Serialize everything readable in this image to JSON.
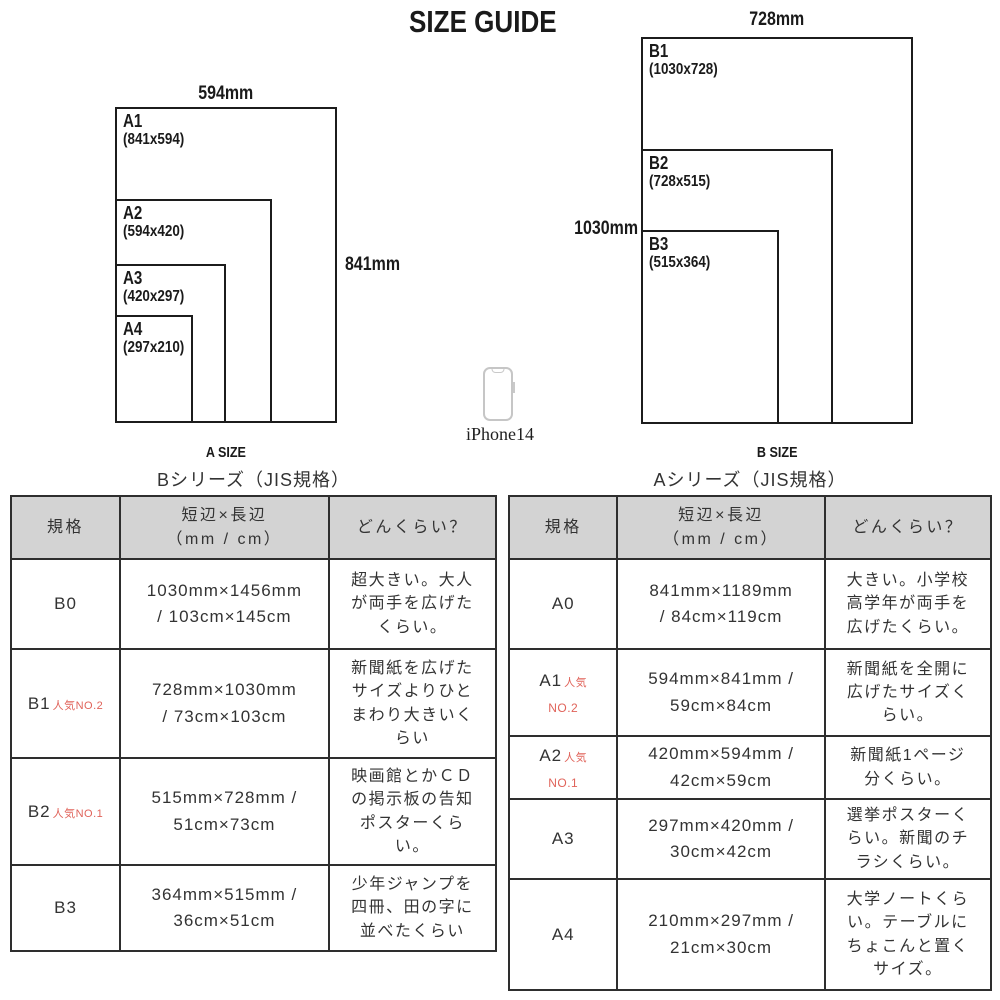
{
  "page_title": "SIZE GUIDE",
  "colors": {
    "accent_red": "#e0635a",
    "header_bg": "#d3d3d3",
    "border": "#2e2e2e"
  },
  "phone": {
    "label": "iPhone14"
  },
  "diagram_a": {
    "caption": "A SIZE",
    "top_dim": "594mm",
    "side_dim": "841mm",
    "sizes": [
      {
        "name": "A1",
        "dims": "(841x594)"
      },
      {
        "name": "A2",
        "dims": "(594x420)"
      },
      {
        "name": "A3",
        "dims": "(420x297)"
      },
      {
        "name": "A4",
        "dims": "(297x210)"
      }
    ]
  },
  "diagram_b": {
    "caption": "B SIZE",
    "top_dim": "728mm",
    "side_dim": "1030mm",
    "sizes": [
      {
        "name": "B1",
        "dims": "(1030x728)"
      },
      {
        "name": "B2",
        "dims": "(728x515)"
      },
      {
        "name": "B3",
        "dims": "(515x364)"
      }
    ]
  },
  "tables": [
    {
      "title": "Bシリーズ（JIS規格）",
      "headers": [
        "規格",
        "短辺×長辺\n（mm / cm）",
        "どんくらい？"
      ],
      "rows": [
        {
          "size": "B0",
          "tag": "",
          "tag_line2": "",
          "dims": "1030mm×1456mm\n/ 103cm×145cm",
          "desc": "超大きい。大人\nが両手を広げた\nくらい。"
        },
        {
          "size": "B1",
          "tag": "人気NO.2",
          "tag_line2": "",
          "dims": "728mm×1030mm\n/ 73cm×103cm",
          "desc": "新聞紙を広げた\nサイズよりひと\nまわり大きいく\nらい"
        },
        {
          "size": "B2",
          "tag": "人気NO.1",
          "tag_line2": "",
          "dims": "515mm×728mm /\n51cm×73cm",
          "desc": "映画館とかＣＤ\nの掲示板の告知\nポスターくら\nい。"
        },
        {
          "size": "B3",
          "tag": "",
          "tag_line2": "",
          "dims": "364mm×515mm /\n36cm×51cm",
          "desc": "少年ジャンプを\n四冊、田の字に\n並べたくらい"
        }
      ]
    },
    {
      "title": "Aシリーズ（JIS規格）",
      "headers": [
        "規格",
        "短辺×長辺\n（mm / cm）",
        "どんくらい？"
      ],
      "rows": [
        {
          "size": "A0",
          "tag": "",
          "tag_line2": "",
          "dims": "841mm×1189mm\n/ 84cm×119cm",
          "desc": "大きい。小学校\n高学年が両手を\n広げたくらい。"
        },
        {
          "size": "A1",
          "tag": "人気",
          "tag_line2": "NO.2",
          "dims": "594mm×841mm /\n59cm×84cm",
          "desc": "新聞紙を全開に\n広げたサイズく\nらい。"
        },
        {
          "size": "A2",
          "tag": "人気",
          "tag_line2": "NO.1",
          "dims": "420mm×594mm /\n42cm×59cm",
          "desc": "新聞紙1ページ\n分くらい。"
        },
        {
          "size": "A3",
          "tag": "",
          "tag_line2": "",
          "dims": "297mm×420mm /\n30cm×42cm",
          "desc": "選挙ポスターく\nらい。新聞のチ\nラシくらい。"
        },
        {
          "size": "A4",
          "tag": "",
          "tag_line2": "",
          "dims": "210mm×297mm /\n21cm×30cm",
          "desc": "大学ノートくら\nい。テーブルに\nちょこんと置く\nサイズ。"
        }
      ]
    }
  ]
}
